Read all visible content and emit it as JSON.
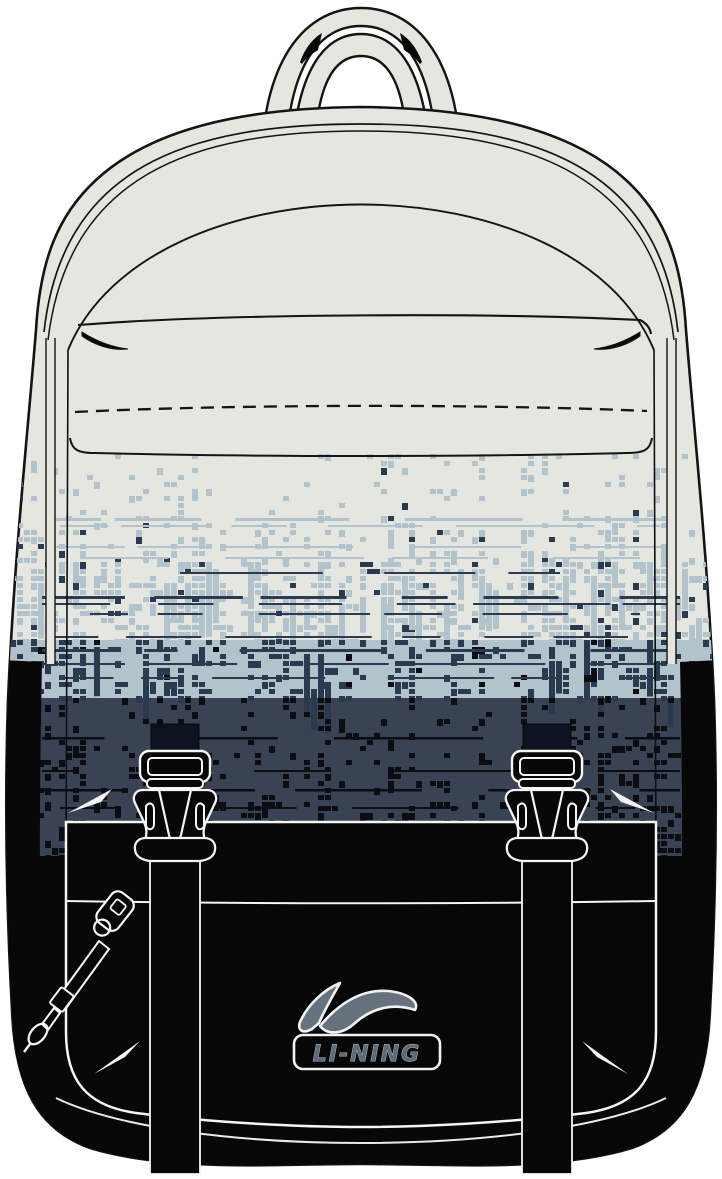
{
  "image": {
    "width": 722,
    "height": 1179,
    "kind": "product illustration",
    "object": "backpack",
    "view": "front"
  },
  "brand": {
    "logo_text": "LI-NING"
  },
  "colors": {
    "page_bg": "#ffffff",
    "body_cream": "#e5e6df",
    "outline": "#141414",
    "outline_soft": "#0c0f16",
    "ink_black": "#070708",
    "strap_dark": "#0d1320",
    "stroke_white": "#f5f5f5",
    "pattern_lightblue": "#b2c3cc",
    "pattern_navy": "#2b3a4f",
    "pattern_navy_bg": "#3a4354",
    "pattern_black": "#0b0d12",
    "logo_swoosh": "#66737f",
    "logo_text_color": "#5d6b79"
  },
  "artwork": {
    "style": "vector line illustration, pixel-glitch gradient fading cream to light blue to navy to black",
    "features": [
      "top-handle",
      "front-zip-panel",
      "dashed-stitch-line",
      "pixel-gradient-print",
      "front-flap",
      "two-side-release-buckles",
      "two-webbing-straps",
      "zipper-pull-lanyard",
      "logo-patch"
    ],
    "pattern": {
      "seed": 20240607,
      "cell": 7,
      "x0": 10,
      "x1": 712,
      "y0": 454,
      "y1": 862,
      "bands": [
        {
          "y0": 454,
          "y1": 516,
          "px": [
            [
              "lightblue",
              0.13
            ],
            [
              "navy",
              0.012
            ]
          ]
        },
        {
          "y0": 516,
          "y1": 562,
          "px": [
            [
              "lightblue",
              0.26
            ],
            [
              "navy",
              0.05
            ]
          ]
        },
        {
          "y0": 562,
          "y1": 640,
          "px": [
            [
              "lightblue",
              0.55
            ],
            [
              "navy",
              0.13
            ]
          ],
          "wide": 0.2,
          "tall": 0.45
        },
        {
          "y0": 640,
          "y1": 698,
          "bg": "lightblue",
          "px": [
            [
              "navy",
              0.34
            ],
            [
              "black",
              0.05
            ]
          ],
          "wide": 0.15,
          "tall": 0.25
        },
        {
          "y0": 698,
          "y1": 746,
          "bg": "navy",
          "px": [
            [
              "black",
              0.2
            ]
          ]
        },
        {
          "y0": 746,
          "y1": 806,
          "bg": "navy",
          "px": [
            [
              "black",
              0.3
            ]
          ],
          "wide": 0.1
        },
        {
          "y0": 806,
          "y1": 862,
          "bg": "navy",
          "px": [
            [
              "black",
              0.44
            ]
          ],
          "wide": 0.12
        }
      ],
      "rails": [
        [
          "lightblue",
          518,
          3,
          50,
          672
        ],
        [
          "lightblue",
          525,
          2,
          60,
          660
        ],
        [
          "lightblue",
          546,
          2,
          50,
          672
        ],
        [
          "lightblue",
          557,
          2,
          80,
          640
        ],
        [
          "navy",
          572,
          2,
          180,
          560
        ],
        [
          "navy",
          596,
          3,
          42,
          680
        ],
        [
          "navy",
          603,
          2,
          42,
          680
        ],
        [
          "navy",
          613,
          2,
          90,
          640
        ],
        [
          "navy",
          636,
          2,
          50,
          672
        ],
        [
          "navy",
          649,
          3,
          42,
          680
        ],
        [
          "navy",
          663,
          2,
          42,
          680
        ],
        [
          "navy",
          677,
          2,
          60,
          660
        ],
        [
          "black",
          737,
          2.5,
          42,
          680
        ],
        [
          "black",
          770,
          2,
          42,
          680
        ],
        [
          "black",
          789,
          2.5,
          42,
          680
        ],
        [
          "black",
          807,
          2,
          60,
          660
        ]
      ]
    }
  }
}
